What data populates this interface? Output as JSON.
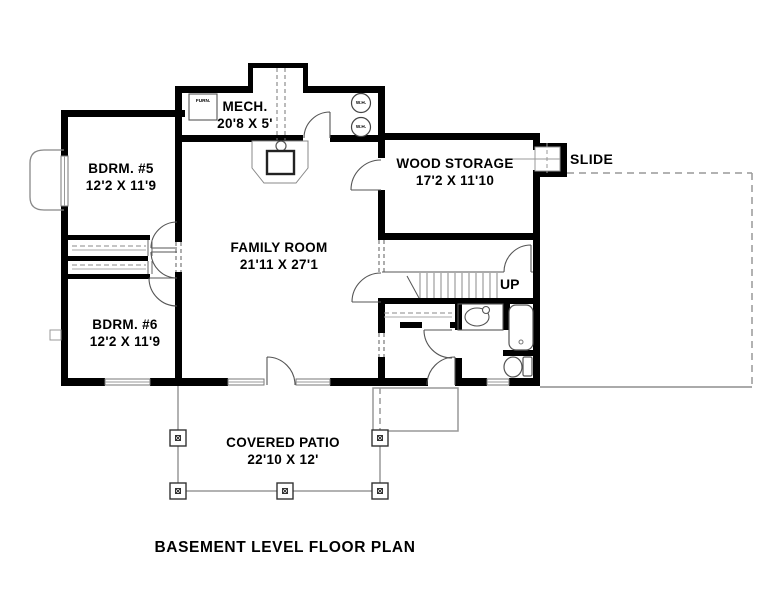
{
  "drawing_title": "BASEMENT LEVEL FLOOR PLAN",
  "rooms": [
    {
      "name": "MECH.",
      "dims": "20'8 X 5'"
    },
    {
      "name": "BDRM. #5",
      "dims": "12'2 X 11'9"
    },
    {
      "name": "WOOD STORAGE",
      "dims": "17'2 X 11'10"
    },
    {
      "name": "FAMILY ROOM",
      "dims": "21'11 X 27'1"
    },
    {
      "name": "BDRM. #6",
      "dims": "12'2 X 11'9"
    },
    {
      "name": "COVERED PATIO",
      "dims": "22'10 X 12'"
    }
  ],
  "labels": {
    "slide": "SLIDE",
    "up": "UP",
    "furnace": "FURN.",
    "water_heater": "W.H."
  },
  "colors": {
    "wall": "#000000",
    "fixture_line": "#555555",
    "light_line": "#999999",
    "background": "#ffffff"
  }
}
